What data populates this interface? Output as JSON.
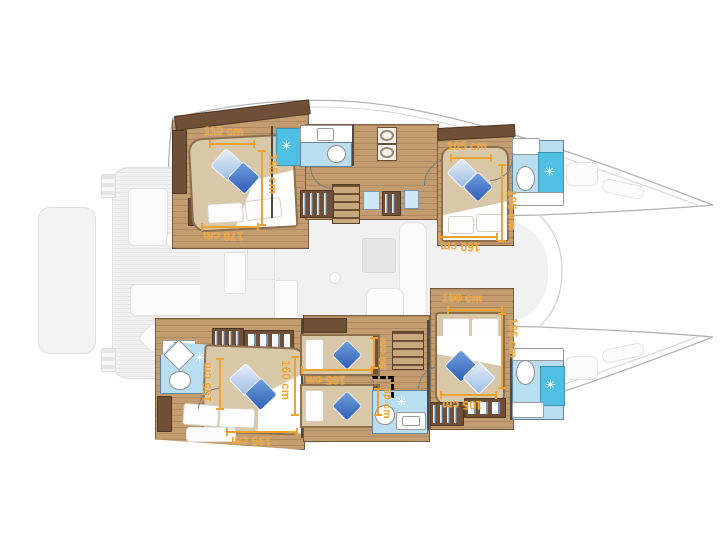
{
  "plan": {
    "type": "catamaran-deck-plan"
  },
  "cabins": {
    "port_aft": {
      "name": "port aft cabin",
      "width": "110 cm",
      "length": "195 cm",
      "entry": "170 cm"
    },
    "port_fore": {
      "name": "port forward cabin",
      "width": "105 cm",
      "length": "195 cm",
      "bed_length": "160 cm"
    },
    "stbd_aft": {
      "name": "starboard aft cabin",
      "entry": "105 cm",
      "bed_length": "160 cm",
      "length": "195 cm"
    },
    "bunk_room": {
      "name": "bunk cabin",
      "upper_bunk": "80 cm",
      "length": "195 cm",
      "lower_bunk": "80 cm"
    },
    "stbd_fore": {
      "name": "starboard fwd cabin",
      "bed_width": "160 cm",
      "length": "195 cm",
      "entry": "105 cm"
    }
  },
  "icons": {
    "compass_rose": "✳"
  },
  "colors": {
    "dimension_orange": "#EFA22F",
    "wood_floor": "#C39C70",
    "cabinet_wood": "#6F4F35",
    "bath_floor": "#B9DEF0",
    "shower_tile": "#4FC0E4",
    "pillow_blue": "#2F5DB5",
    "pillow_light": "#9DBDE4",
    "salon_floor": "#F0F0F0",
    "hull_outline": "#B3B3B3"
  }
}
